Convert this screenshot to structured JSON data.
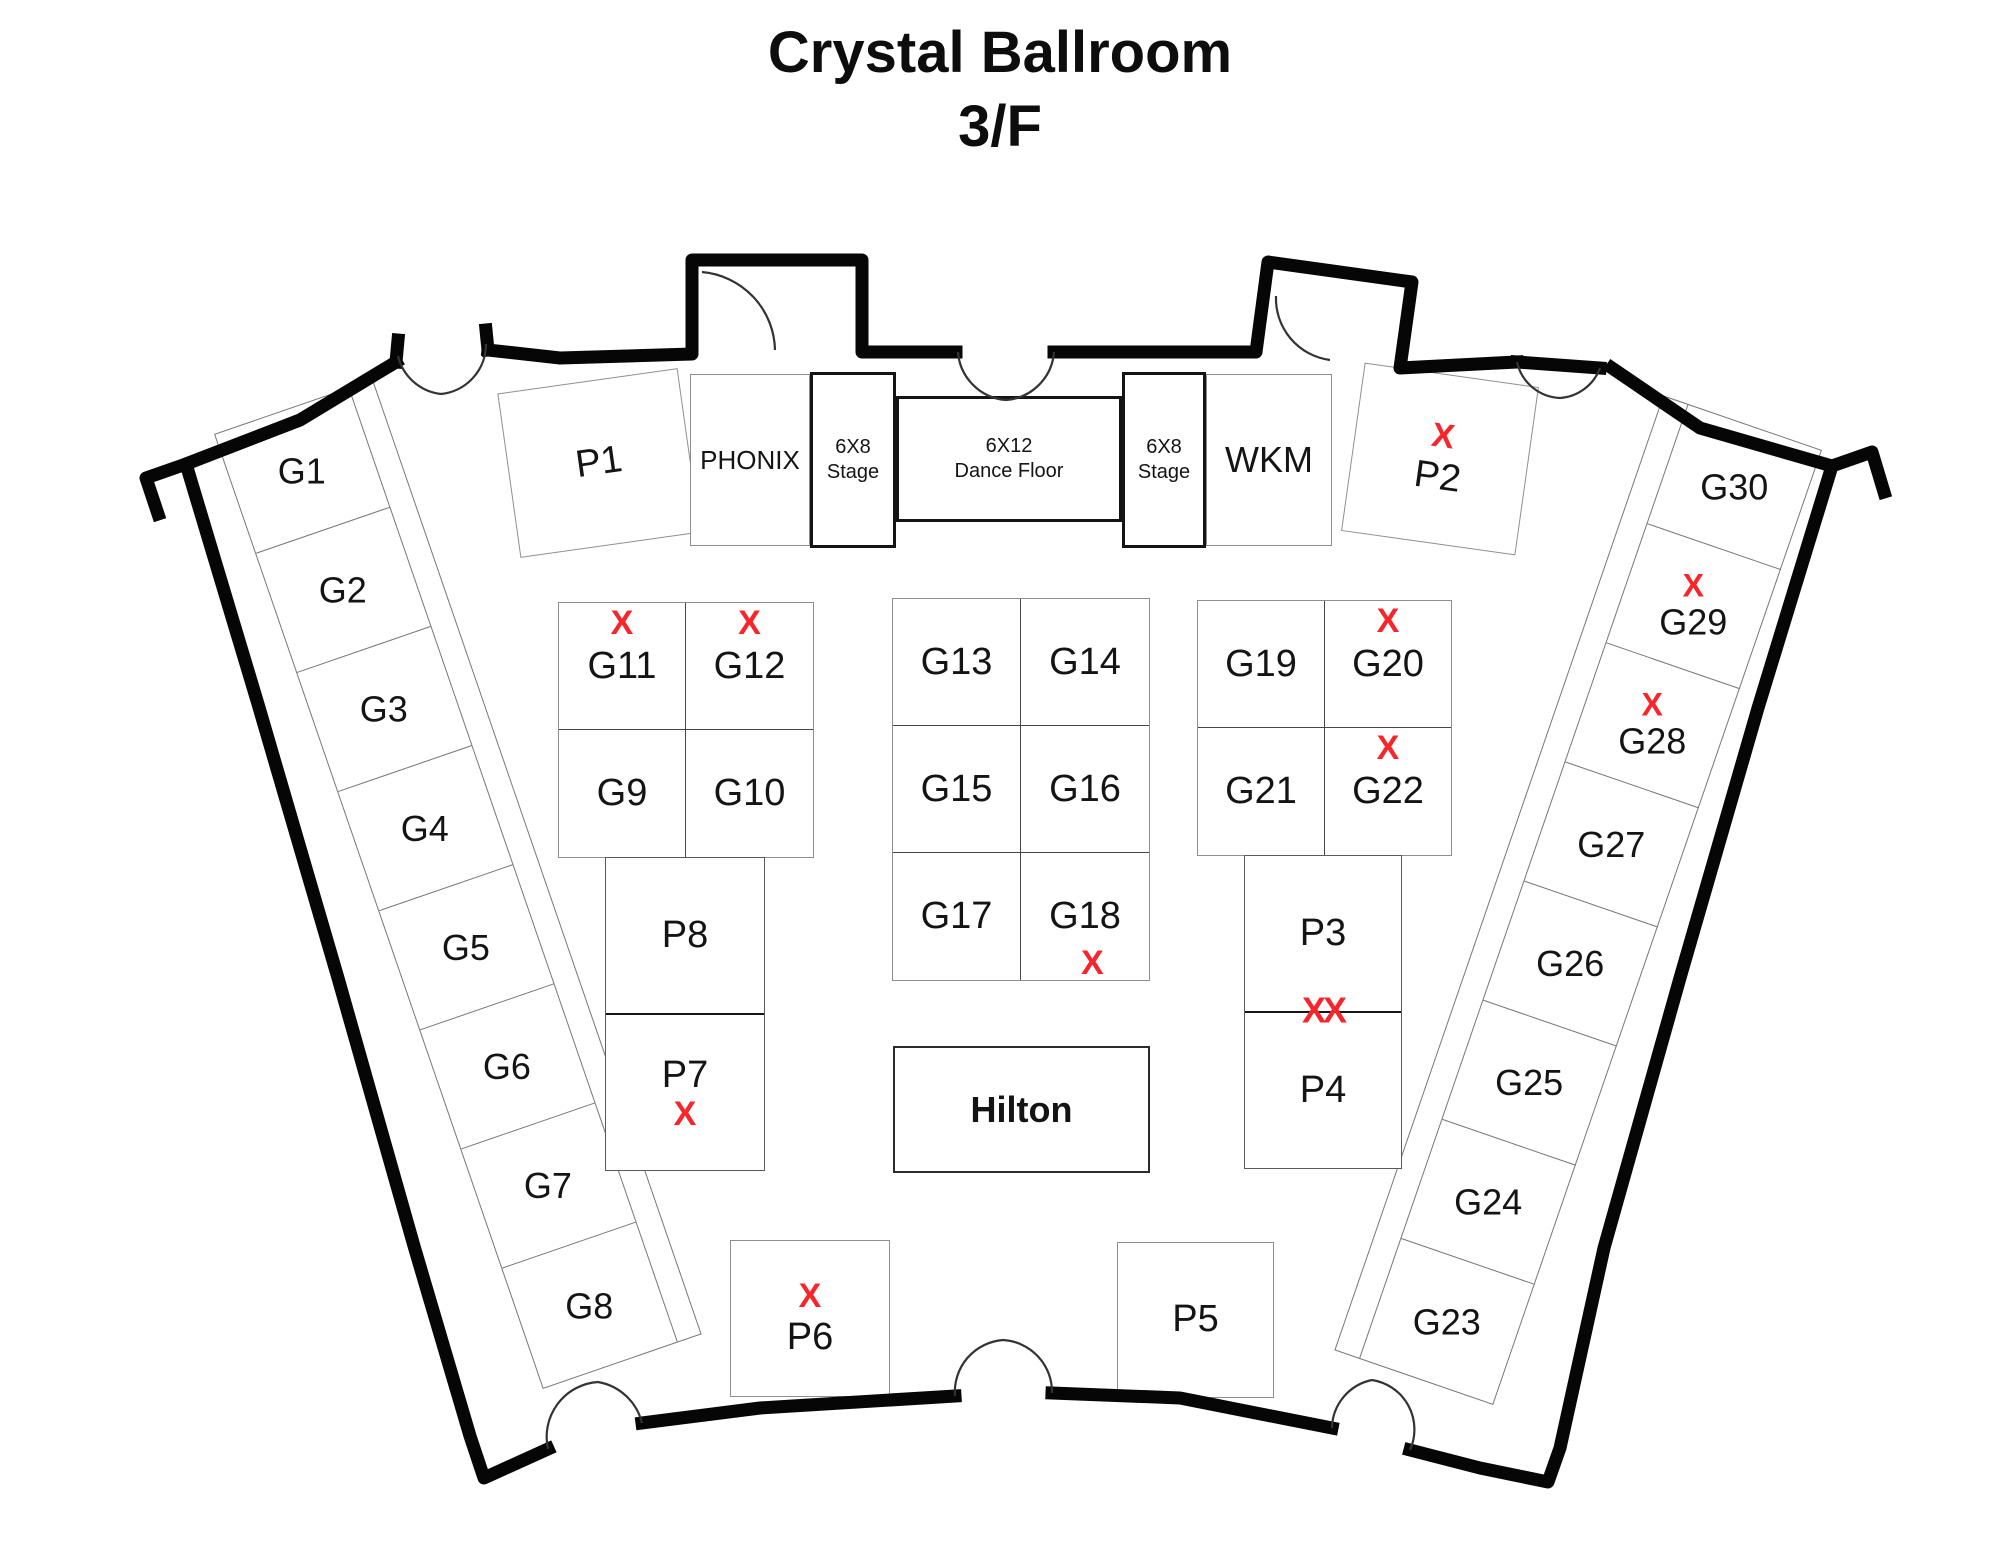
{
  "title": {
    "line1": "Crystal Ballroom",
    "line2": "3/F"
  },
  "colors": {
    "mark_red": "#f8262a",
    "wall_black": "#060606"
  },
  "top_row": {
    "p1": {
      "label": "P1",
      "mark": ""
    },
    "phonix": {
      "label": "PHONIX"
    },
    "stage_left": {
      "line1": "6X8",
      "line2": "Stage"
    },
    "dance_floor": {
      "line1": "6X12",
      "line2": "Dance Floor"
    },
    "stage_right": {
      "line1": "6X8",
      "line2": "Stage"
    },
    "wkm": {
      "label": "WKM"
    },
    "p2": {
      "label": "P2",
      "mark": "X"
    }
  },
  "left_column": [
    {
      "label": "G1",
      "mark": ""
    },
    {
      "label": "G2",
      "mark": ""
    },
    {
      "label": "G3",
      "mark": ""
    },
    {
      "label": "G4",
      "mark": ""
    },
    {
      "label": "G5",
      "mark": ""
    },
    {
      "label": "G6",
      "mark": ""
    },
    {
      "label": "G7",
      "mark": ""
    },
    {
      "label": "G8",
      "mark": ""
    }
  ],
  "right_column": [
    {
      "label": "G30",
      "mark": ""
    },
    {
      "label": "G29",
      "mark": "X"
    },
    {
      "label": "G28",
      "mark": "X"
    },
    {
      "label": "G27",
      "mark": ""
    },
    {
      "label": "G26",
      "mark": ""
    },
    {
      "label": "G25",
      "mark": ""
    },
    {
      "label": "G24",
      "mark": ""
    },
    {
      "label": "G23",
      "mark": ""
    }
  ],
  "left_cluster": [
    [
      {
        "label": "G11",
        "mark": "X"
      },
      {
        "label": "G12",
        "mark": "X"
      }
    ],
    [
      {
        "label": "G9",
        "mark": ""
      },
      {
        "label": "G10",
        "mark": ""
      }
    ]
  ],
  "center_cluster": [
    [
      {
        "label": "G13",
        "mark": ""
      },
      {
        "label": "G14",
        "mark": ""
      }
    ],
    [
      {
        "label": "G15",
        "mark": ""
      },
      {
        "label": "G16",
        "mark": ""
      }
    ],
    [
      {
        "label": "G17",
        "mark": ""
      },
      {
        "label": "G18",
        "mark_below": "X"
      }
    ]
  ],
  "right_cluster": [
    [
      {
        "label": "G19",
        "mark": ""
      },
      {
        "label": "G20",
        "mark": "X"
      }
    ],
    [
      {
        "label": "G21",
        "mark": ""
      },
      {
        "label": "G22",
        "mark": "X"
      }
    ]
  ],
  "p_stack_left": [
    {
      "label": "P8",
      "mark_below": ""
    },
    {
      "label": "P7",
      "mark_below": "X"
    }
  ],
  "p_stack_right": {
    "cells": [
      {
        "label": "P3"
      },
      {
        "label": "P4"
      }
    ],
    "divider_mark": "XX"
  },
  "hilton": {
    "label": "Hilton"
  },
  "bottom_row": {
    "p6": {
      "label": "P6",
      "mark": "X"
    },
    "p5": {
      "label": "P5",
      "mark": ""
    }
  }
}
